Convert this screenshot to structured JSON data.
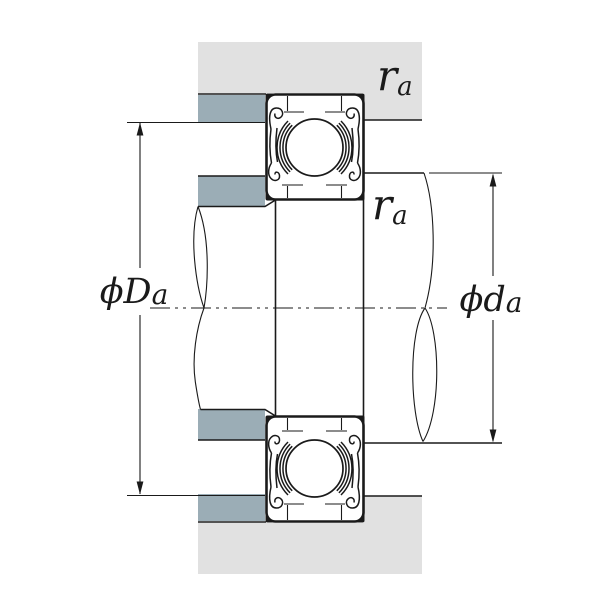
{
  "diagram": {
    "title": "Ball bearing mounting cross-section (shaft and housing abutment dimensions)",
    "labels": {
      "housing_fillet_radius": {
        "main": "r",
        "sub": "a"
      },
      "shaft_fillet_radius": {
        "main": "r",
        "sub": "a"
      },
      "housing_abutment_diameter": {
        "main": "ϕD",
        "sub": "a"
      },
      "shaft_abutment_diameter": {
        "main": "ϕd",
        "sub": "a"
      }
    }
  },
  "colors": {
    "housing": "#e1e1e1",
    "shoulder": "#9badb6",
    "line": "#1a1a1a",
    "background": "#ffffff"
  }
}
